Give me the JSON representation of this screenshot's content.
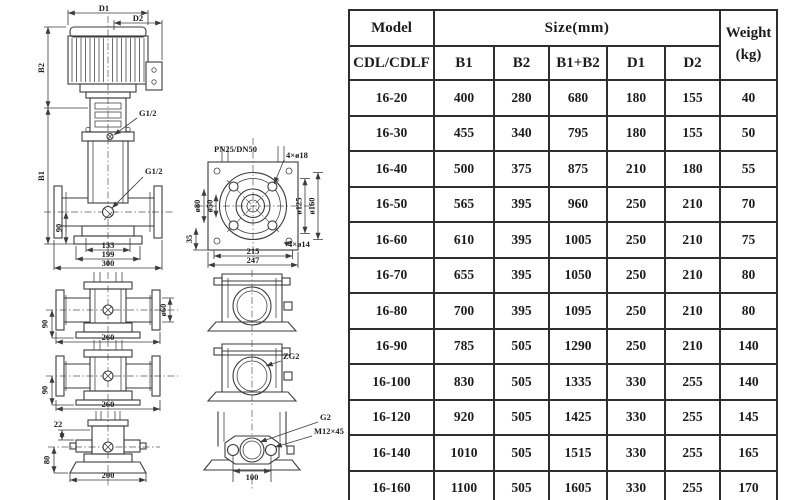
{
  "drawing": {
    "front_view": {
      "dim_d1": "D1",
      "dim_d2": "D2",
      "dim_b2": "B2",
      "dim_b1": "B1",
      "port_coupling": "G1/2",
      "port_drain": "G1/2",
      "dim_90": "90",
      "dim_133": "133",
      "dim_199": "199",
      "dim_300": "300"
    },
    "flange_top_view": {
      "rating": "PN25/DN50",
      "holes_flange": "4×ø18",
      "holes_base": "4×ø14",
      "dia_hub": "ø80",
      "dia_bore": "ø50",
      "dia_bolt_circle": "ø125",
      "dia_flange": "ø160",
      "dim_35": "35",
      "dim_215": "215",
      "dim_247": "247"
    },
    "pump_view_a": {
      "dim_90": "90",
      "dim_260": "260",
      "dia_60": "ø60"
    },
    "pump_view_b": {
      "dim_90": "90",
      "dim_260": "260"
    },
    "pump_view_c": {
      "dim_22": "22",
      "dim_80": "80",
      "dim_200": "200"
    },
    "port_view": {
      "thread": "ZG2"
    },
    "oval_flange_view": {
      "thread": "G2",
      "bolt_spec": "M12×45",
      "dim_100": "100"
    }
  },
  "table": {
    "header": {
      "model": "Model",
      "model_sub": "CDL/CDLF",
      "size_group": "Size(mm)",
      "size_cols": [
        "B1",
        "B2",
        "B1+B2",
        "D1",
        "D2"
      ],
      "weight_line1": "Weight",
      "weight_line2": "(kg)"
    },
    "rows": [
      {
        "model": "16-20",
        "b1": "400",
        "b2": "280",
        "b1b2": "680",
        "d1": "180",
        "d2": "155",
        "weight": "40"
      },
      {
        "model": "16-30",
        "b1": "455",
        "b2": "340",
        "b1b2": "795",
        "d1": "180",
        "d2": "155",
        "weight": "50"
      },
      {
        "model": "16-40",
        "b1": "500",
        "b2": "375",
        "b1b2": "875",
        "d1": "210",
        "d2": "180",
        "weight": "55"
      },
      {
        "model": "16-50",
        "b1": "565",
        "b2": "395",
        "b1b2": "960",
        "d1": "250",
        "d2": "210",
        "weight": "70"
      },
      {
        "model": "16-60",
        "b1": "610",
        "b2": "395",
        "b1b2": "1005",
        "d1": "250",
        "d2": "210",
        "weight": "75"
      },
      {
        "model": "16-70",
        "b1": "655",
        "b2": "395",
        "b1b2": "1050",
        "d1": "250",
        "d2": "210",
        "weight": "80"
      },
      {
        "model": "16-80",
        "b1": "700",
        "b2": "395",
        "b1b2": "1095",
        "d1": "250",
        "d2": "210",
        "weight": "80"
      },
      {
        "model": "16-90",
        "b1": "785",
        "b2": "505",
        "b1b2": "1290",
        "d1": "250",
        "d2": "210",
        "weight": "140"
      },
      {
        "model": "16-100",
        "b1": "830",
        "b2": "505",
        "b1b2": "1335",
        "d1": "330",
        "d2": "255",
        "weight": "140"
      },
      {
        "model": "16-120",
        "b1": "920",
        "b2": "505",
        "b1b2": "1425",
        "d1": "330",
        "d2": "255",
        "weight": "145"
      },
      {
        "model": "16-140",
        "b1": "1010",
        "b2": "505",
        "b1b2": "1515",
        "d1": "330",
        "d2": "255",
        "weight": "165"
      },
      {
        "model": "16-160",
        "b1": "1100",
        "b2": "505",
        "b1b2": "1605",
        "d1": "330",
        "d2": "255",
        "weight": "170"
      }
    ]
  }
}
